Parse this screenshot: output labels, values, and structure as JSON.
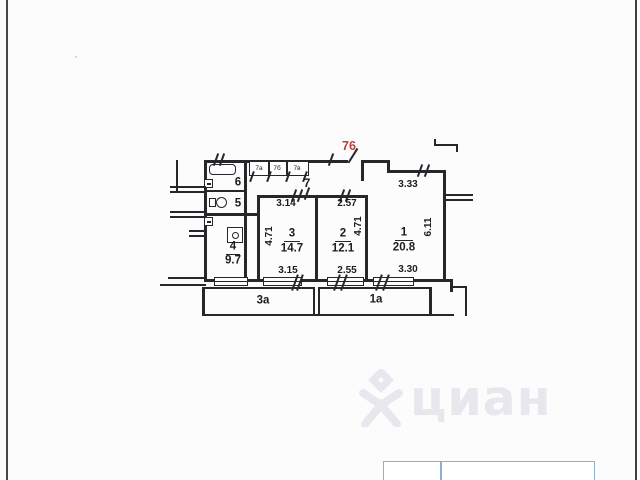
{
  "plan": {
    "apartment_number": "76",
    "rooms": {
      "room1": {
        "number": "1",
        "area": "20.8"
      },
      "room2": {
        "number": "2",
        "area": "12.1"
      },
      "room3": {
        "number": "3",
        "area": "14.7"
      },
      "room4": {
        "number": "4",
        "area": "9.7"
      },
      "room5": {
        "number": "5"
      },
      "room6": {
        "number": "6"
      },
      "room7": {
        "number": "7"
      },
      "closet_a": {
        "number": "7а"
      },
      "closet_b": {
        "number": "7б"
      },
      "closet_c": {
        "number": "7в"
      }
    },
    "dimensions": {
      "room3_top": "3.14",
      "room2_top": "2.57",
      "room1_top": "3.33",
      "room3_left_height": "4.71",
      "room2_right_height": "4.71",
      "room1_right_height": "6.11",
      "room3_bottom": "3.15",
      "room2_bottom": "2.55",
      "room1_bottom": "3.30"
    },
    "balconies": {
      "left_label": "3а",
      "right_label": "1а"
    },
    "colors": {
      "wall": "#26262b",
      "apartment_number": "#b8403a"
    }
  },
  "watermark": {
    "text": "циан",
    "color": "#e9e7ee"
  },
  "footer_box": {
    "border_color": "#8fafd2"
  }
}
